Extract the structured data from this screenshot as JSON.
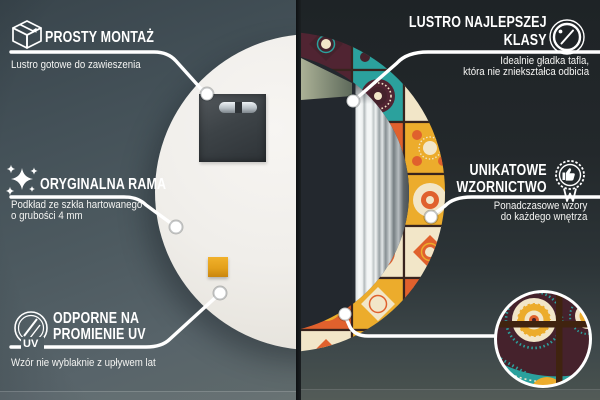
{
  "callouts": {
    "simple_mounting": {
      "icon": "package-box-icon",
      "title": "PROSTY MONTAŻ",
      "subtitle": "Lustro gotowe do zawieszenia"
    },
    "original_frame": {
      "icon": "sparkles-icon",
      "title": "ORYGINALNA RAMA",
      "subtitle_line1": "Podkład ze szkła hartowanego",
      "subtitle_line2": "o grubości 4 mm"
    },
    "uv_resistant": {
      "icon": "uv-circle-icon",
      "icon_label": "UV",
      "title_line1": "ODPORNE NA",
      "title_line2": "PROMIENIE UV",
      "subtitle": "Wzór nie wyblaknie z upływem lat"
    },
    "top_class_mirror": {
      "icon": "mirror-shine-icon",
      "title_line1": "LUSTRO NAJLEPSZEJ",
      "title_line2": "KLASY",
      "subtitle_line1": "Idealnie gładka tafla,",
      "subtitle_line2": "która nie zniekształca odbicia"
    },
    "unique_design": {
      "icon": "award-badge-icon",
      "title_line1": "UNIKATOWE",
      "title_line2": "WZORNICTWO",
      "subtitle_line1": "Ponadczasowe wzory",
      "subtitle_line2": "do każdego wnętrza"
    }
  },
  "colors": {
    "callout_line": "#ffffff",
    "left_background": "#4c585e",
    "right_background": "#23282b",
    "mirror_back": "#f2f0ec",
    "mounting_plate": "#3d4347",
    "felt_pad_orange": "#e7a31d",
    "frame_palette": [
      "#ecac2c",
      "#2ba19d",
      "#f2e6c8",
      "#502432",
      "#e0612d",
      "#45222c"
    ],
    "tile_grout": "#38241e",
    "detail_cross_brown": "#40230f",
    "curtain_highlight": "#f6f8f8"
  }
}
